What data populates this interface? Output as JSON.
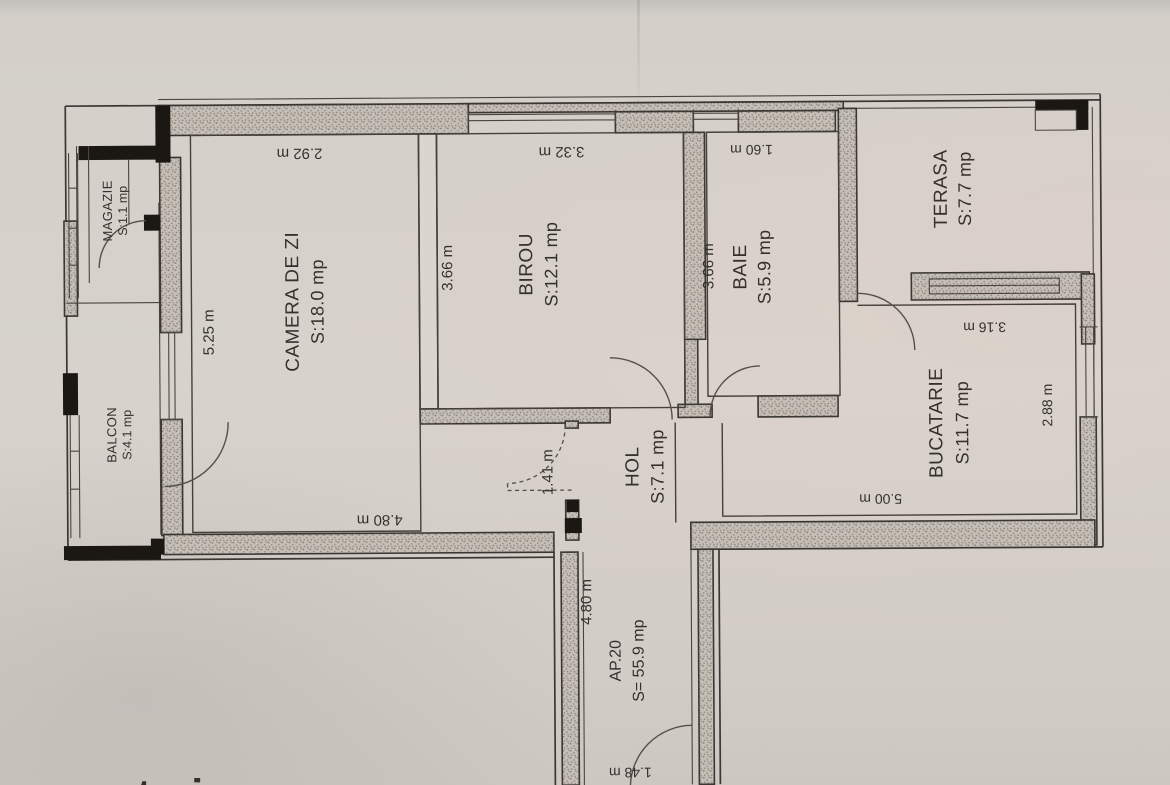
{
  "photo": {
    "watermark": "storia"
  },
  "plan": {
    "apartment": {
      "label": "AP.20",
      "area": "S= 55.9 mp"
    },
    "rooms": [
      {
        "id": "camera-de-zi",
        "name": "CAMERA DE ZI",
        "area": "S:18.0 mp"
      },
      {
        "id": "birou",
        "name": "BIROU",
        "area": "S:12.1 mp"
      },
      {
        "id": "baie",
        "name": "BAIE",
        "area": "S:5.9 mp"
      },
      {
        "id": "terasa",
        "name": "TERASA",
        "area": "S:7.7 mp"
      },
      {
        "id": "bucatarie",
        "name": "BUCATARIE",
        "area": "S:11.7 mp"
      },
      {
        "id": "hol",
        "name": "HOL",
        "area": "S:7.1 mp"
      },
      {
        "id": "magazie",
        "name": "MAGAZIE",
        "area": "S:1.1 mp"
      },
      {
        "id": "balcon",
        "name": "BALCON",
        "area": "S:4.1 mp"
      }
    ],
    "dims": {
      "camera_top": "2.92 m",
      "birou_top": "3.32 m",
      "baie_top": "1.60 m",
      "camera_left": "5.25 m",
      "birou_left": "3.66 m",
      "baie_left": "3.66 m",
      "terasa_bottom": "3.16 m",
      "bucatarie_right": "2.88 m",
      "bucatarie_bottom": "5.00 m",
      "camera_bottom": "4.80 m",
      "hol_door": "1.41 m",
      "corridor": "4.80 m",
      "entrance_door": "1.48 m"
    },
    "colors": {
      "paper": "#d6d1cb",
      "ink": "#3b3733",
      "wall_fill": "#c5bfb7",
      "black_wall": "#1b1713",
      "watermark": "#f6f3eb"
    }
  }
}
